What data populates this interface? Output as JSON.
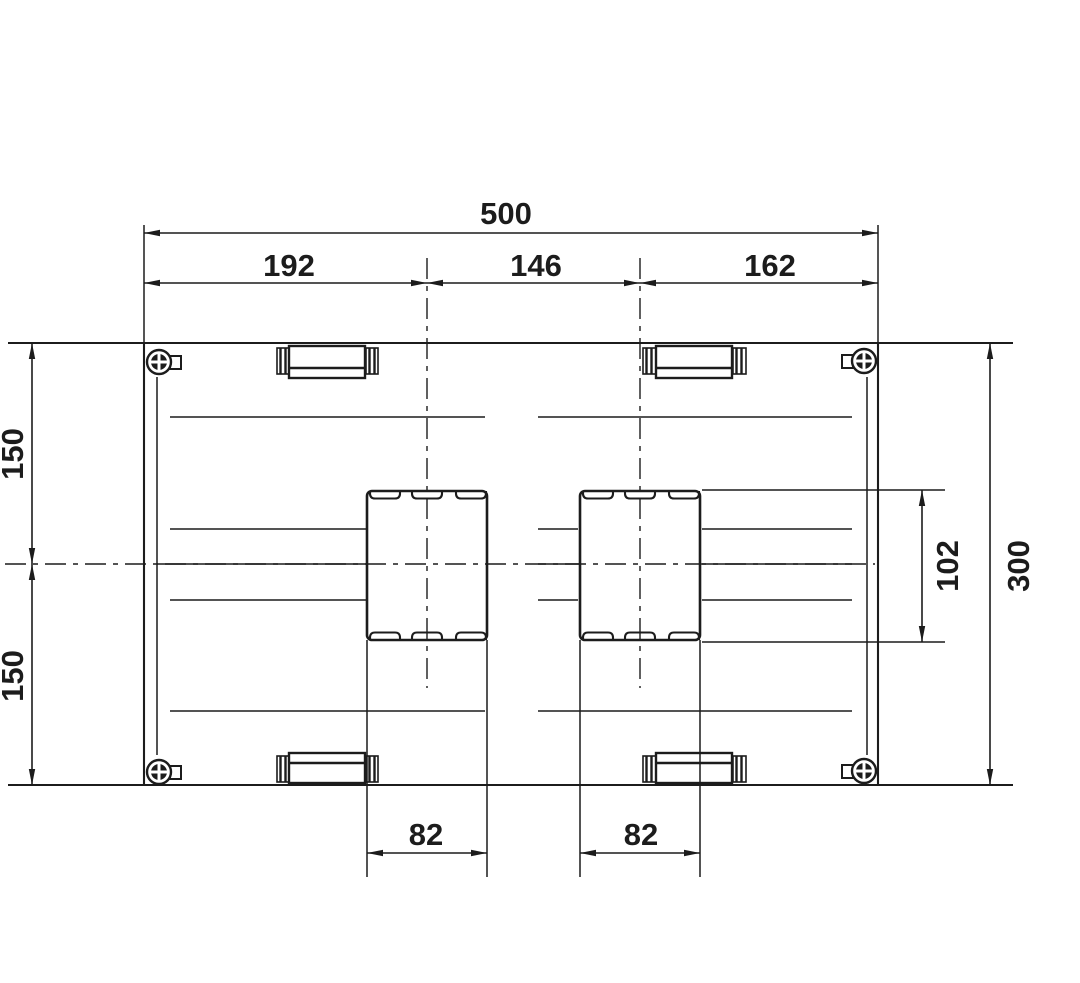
{
  "drawing": {
    "title": "dimensioned top view technical drawing",
    "line_color": "#1c1c1c",
    "background_color": "#ffffff",
    "dimensions": {
      "overall_width": "500",
      "left_span": "192",
      "center_span": "146",
      "right_span": "162",
      "upper_half_height": "150",
      "lower_half_height": "150",
      "overall_height": "300",
      "carriage_height": "102",
      "left_carriage_width": "82",
      "right_carriage_width": "82"
    }
  }
}
